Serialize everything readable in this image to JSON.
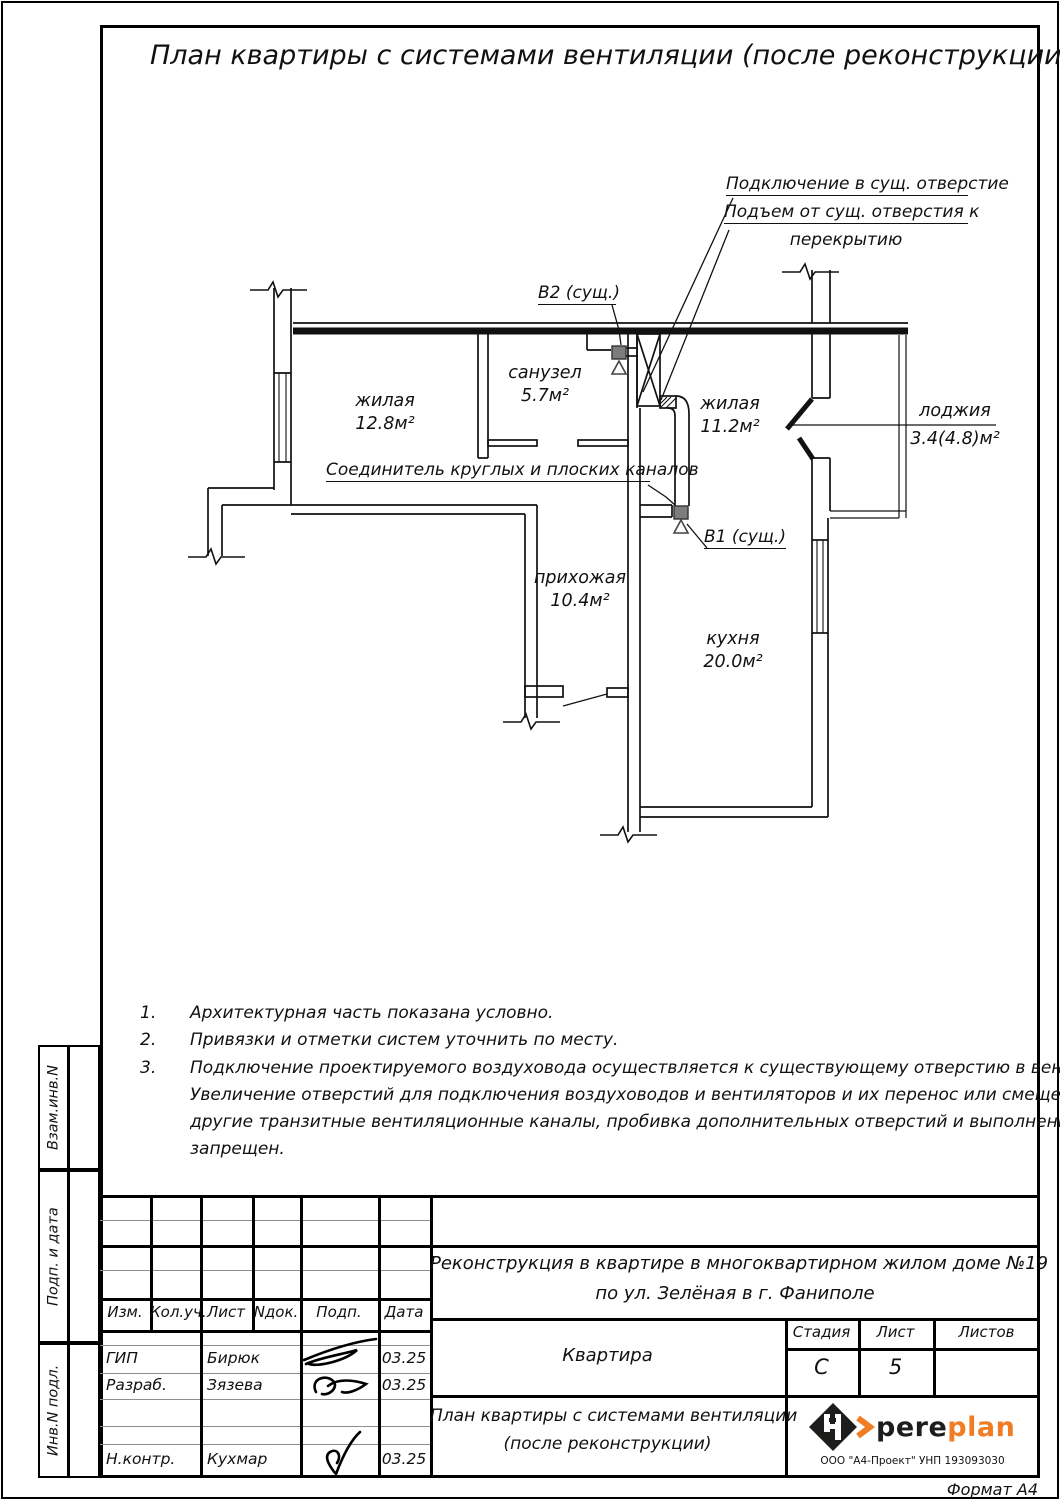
{
  "colors": {
    "line": "#111111",
    "accent_orange": "#f07c23",
    "marker_gray": "#7d7d7d"
  },
  "sheet": {
    "title": "План квартиры с системами вентиляции (после реконструкции)",
    "format_label": "Формат А4"
  },
  "plan": {
    "rooms": [
      {
        "name": "жилая",
        "area": "12.8м²"
      },
      {
        "name": "санузел",
        "area": "5.7м²"
      },
      {
        "name": "жилая",
        "area": "11.2м²"
      },
      {
        "name": "лоджия",
        "area": "3.4(4.8)м²"
      },
      {
        "name": "прихожая",
        "area": "10.4м²"
      },
      {
        "name": "кухня",
        "area": "20.0м²"
      }
    ],
    "annotations": {
      "connect": "Подключение в сущ. отверстие",
      "rise_line1": "Подъем от сущ. отверстия к",
      "rise_line2": "перекрытию",
      "v2": "В2 (сущ.)",
      "connector": "Соединитель круглых и плоских каналов",
      "v1": "В1 (сущ.)"
    }
  },
  "notes": [
    {
      "num": "1.",
      "lines": [
        "Архитектурная часть показана условно."
      ]
    },
    {
      "num": "2.",
      "lines": [
        "Привязки и отметки систем уточнить по месту."
      ]
    },
    {
      "num": "3.",
      "lines": [
        "Подключение проектируемого воздуховода осуществляется к существующему отверстию в вентканале.",
        "Увеличение отверстий для подключения воздуховодов и вентиляторов и их перенос или смещение в",
        "другие транзитные вентиляционные каналы, пробивка дополнительных отверстий и выполнение штраб –",
        "запрещен."
      ]
    }
  ],
  "side_stamps": [
    "Взам.инв.N",
    "Подп. и дата",
    "Инв.N подл."
  ],
  "titleblock": {
    "columns": [
      "Изм.",
      "Кол.уч.",
      "Лист",
      "Nдок.",
      "Подп.",
      "Дата"
    ],
    "rows": [
      {
        "role": "ГИП",
        "name": "Бирюк",
        "date": "03.25"
      },
      {
        "role": "Разраб.",
        "name": "Зязева",
        "date": "03.25"
      },
      {
        "role": "Н.контр.",
        "name": "Кухмар",
        "date": "03.25"
      }
    ],
    "project_line1": "Реконструкция в квартире в многоквартирном жилом доме №19",
    "project_line2": "по ул. Зелёная в г. Фаниполе",
    "object_name": "Квартира",
    "stage_label": "Стадия",
    "stage_value": "С",
    "sheet_label": "Лист",
    "sheet_value": "5",
    "sheets_label": "Листов",
    "sheets_value": "",
    "doc_line1": "План квартиры с системами вентиляции",
    "doc_line2": "(после реконструкции)",
    "logo_text_black": "pere",
    "logo_text_orange": "plan",
    "company": "ООО \"А4-Проект\" УНП 193093030"
  }
}
